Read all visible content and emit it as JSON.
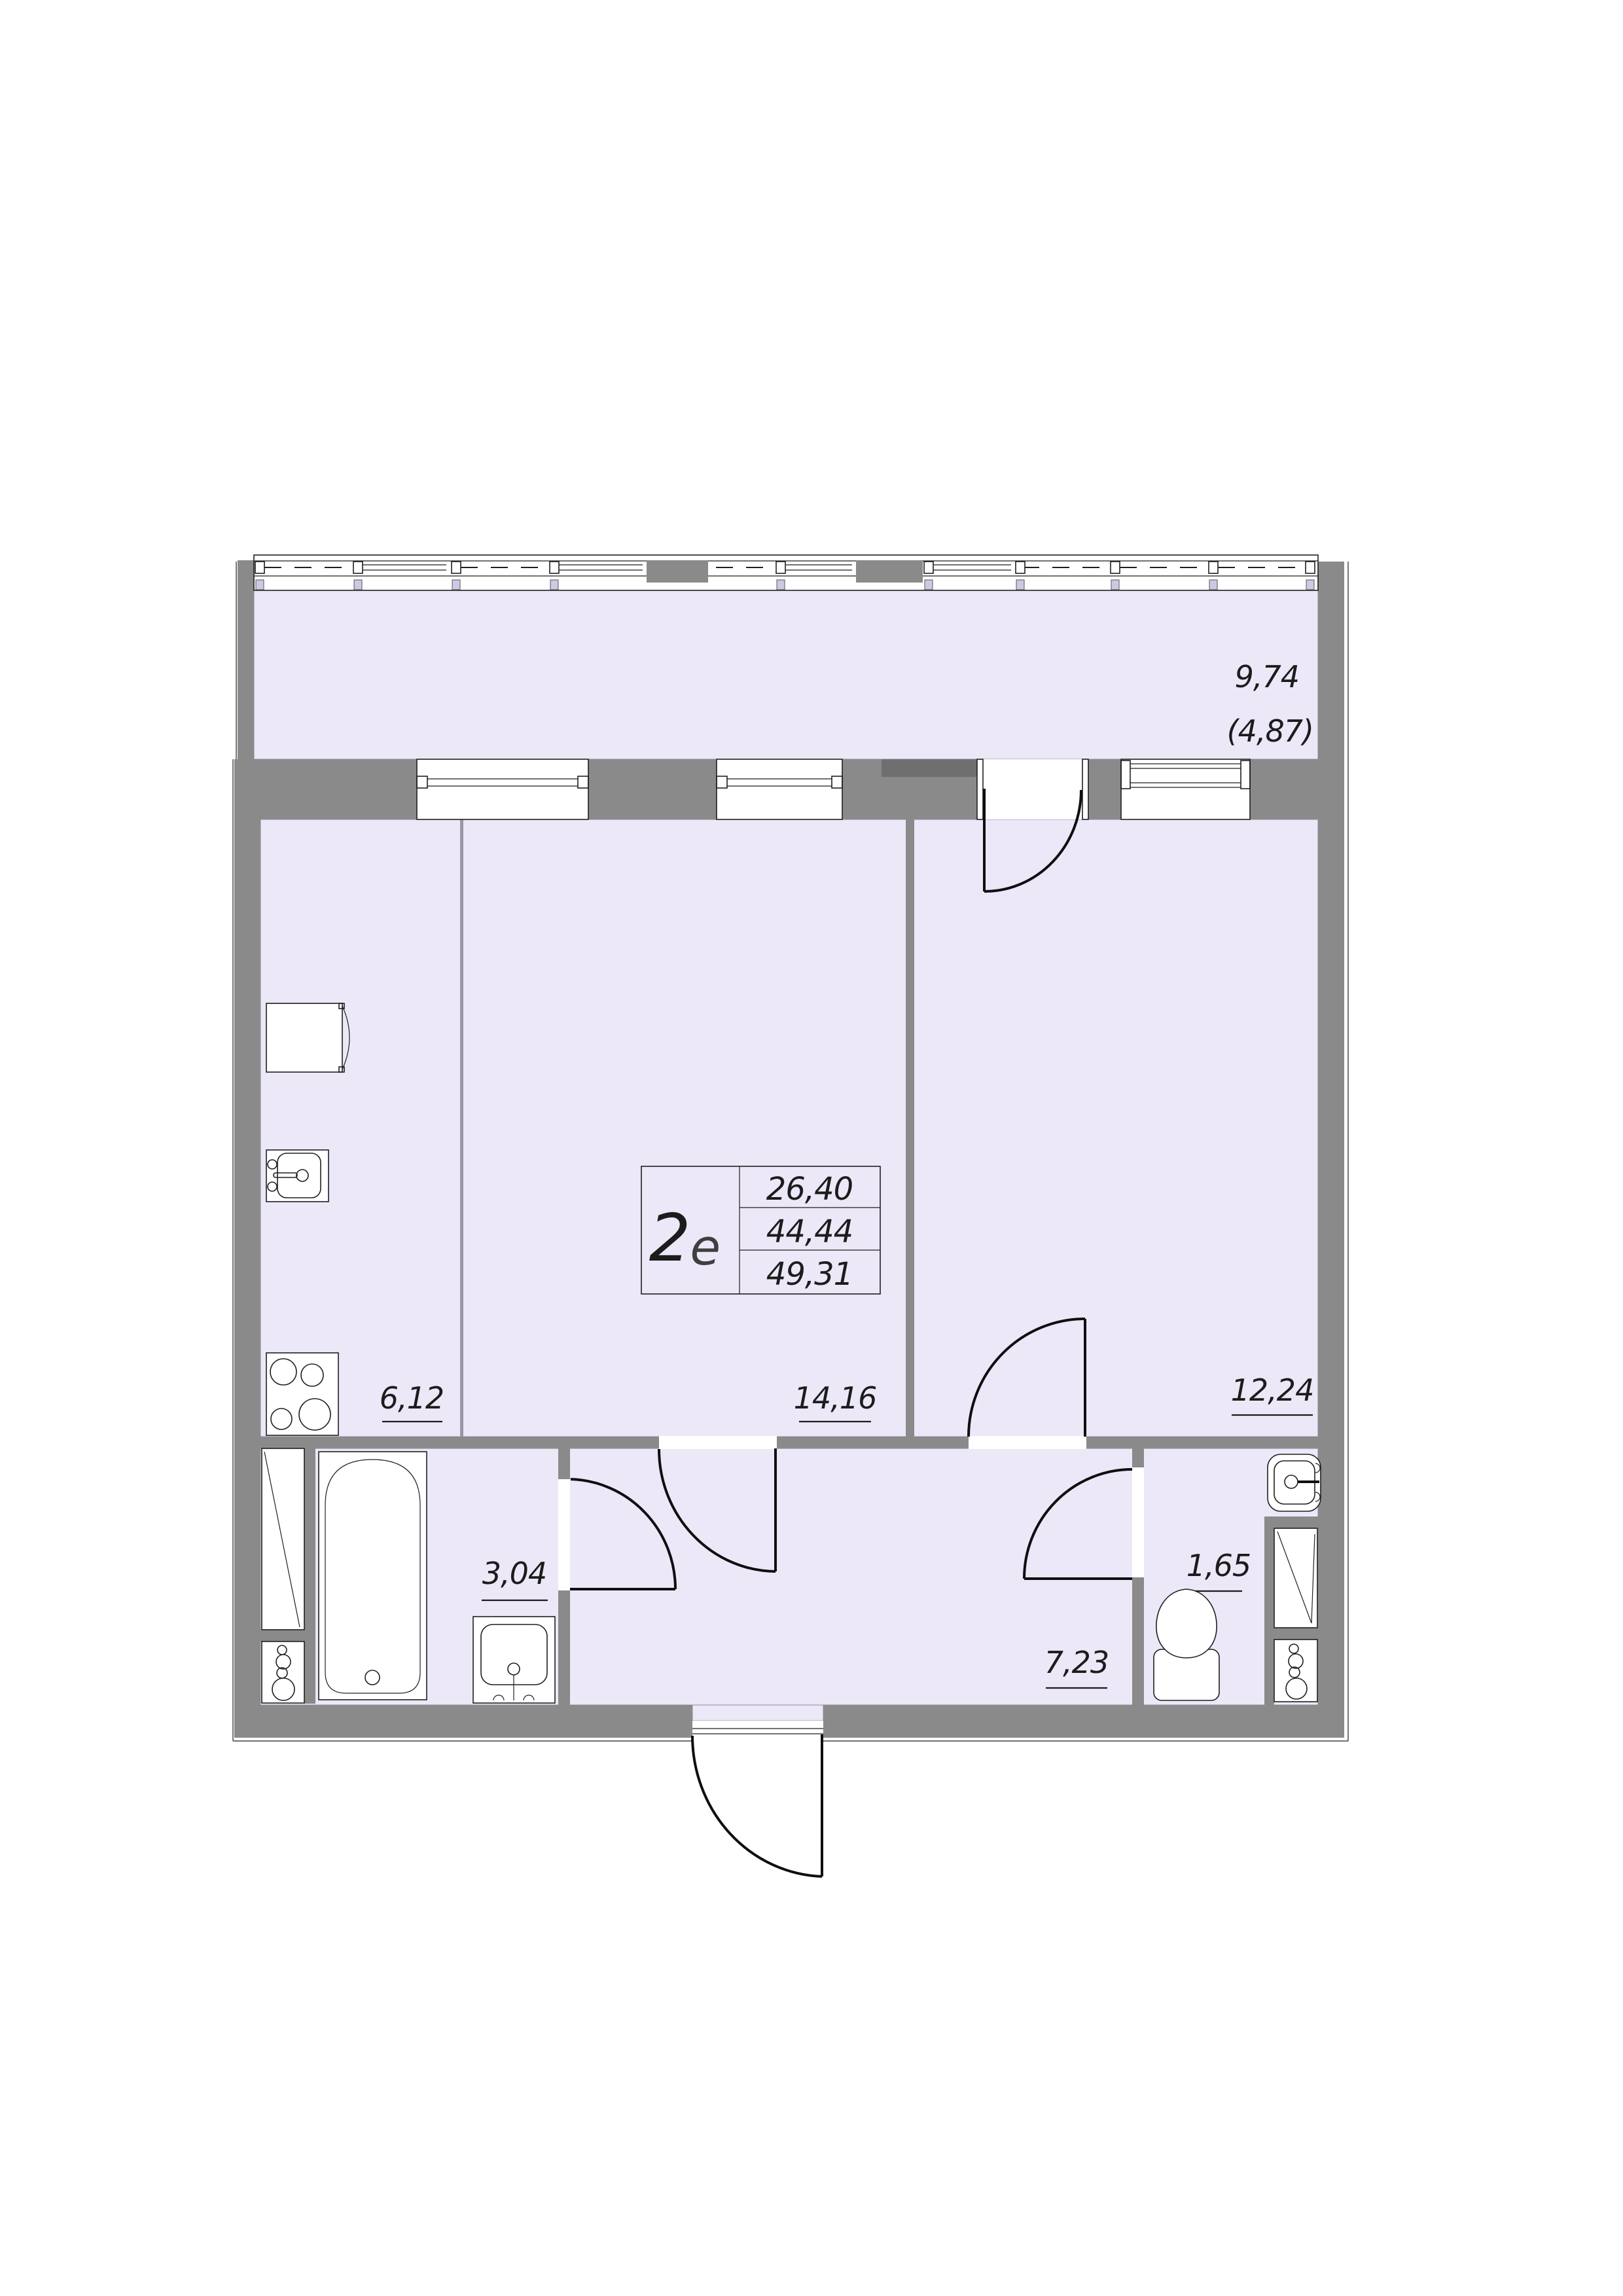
{
  "colors": {
    "floor_fill": "#ece8f8",
    "wall_gray": "#8a8a8a",
    "wall_dark_gray": "#6f6f6f",
    "line_black": "#1f1f1f"
  },
  "apartment": {
    "type_label_prefix": "2",
    "type_label_suffix": "е",
    "area_rows": [
      "26,40",
      "44,44",
      "49,31"
    ]
  },
  "rooms": {
    "balcony": {
      "area": "9,74",
      "area_reduced": "(4,87)"
    },
    "kitchen": {
      "area": "6,12"
    },
    "living": {
      "area": "14,16"
    },
    "bedroom": {
      "area": "12,24"
    },
    "bathroom": {
      "area": "3,04"
    },
    "hallway": {
      "area": "7,23"
    },
    "toilet": {
      "area": "1,65"
    }
  }
}
